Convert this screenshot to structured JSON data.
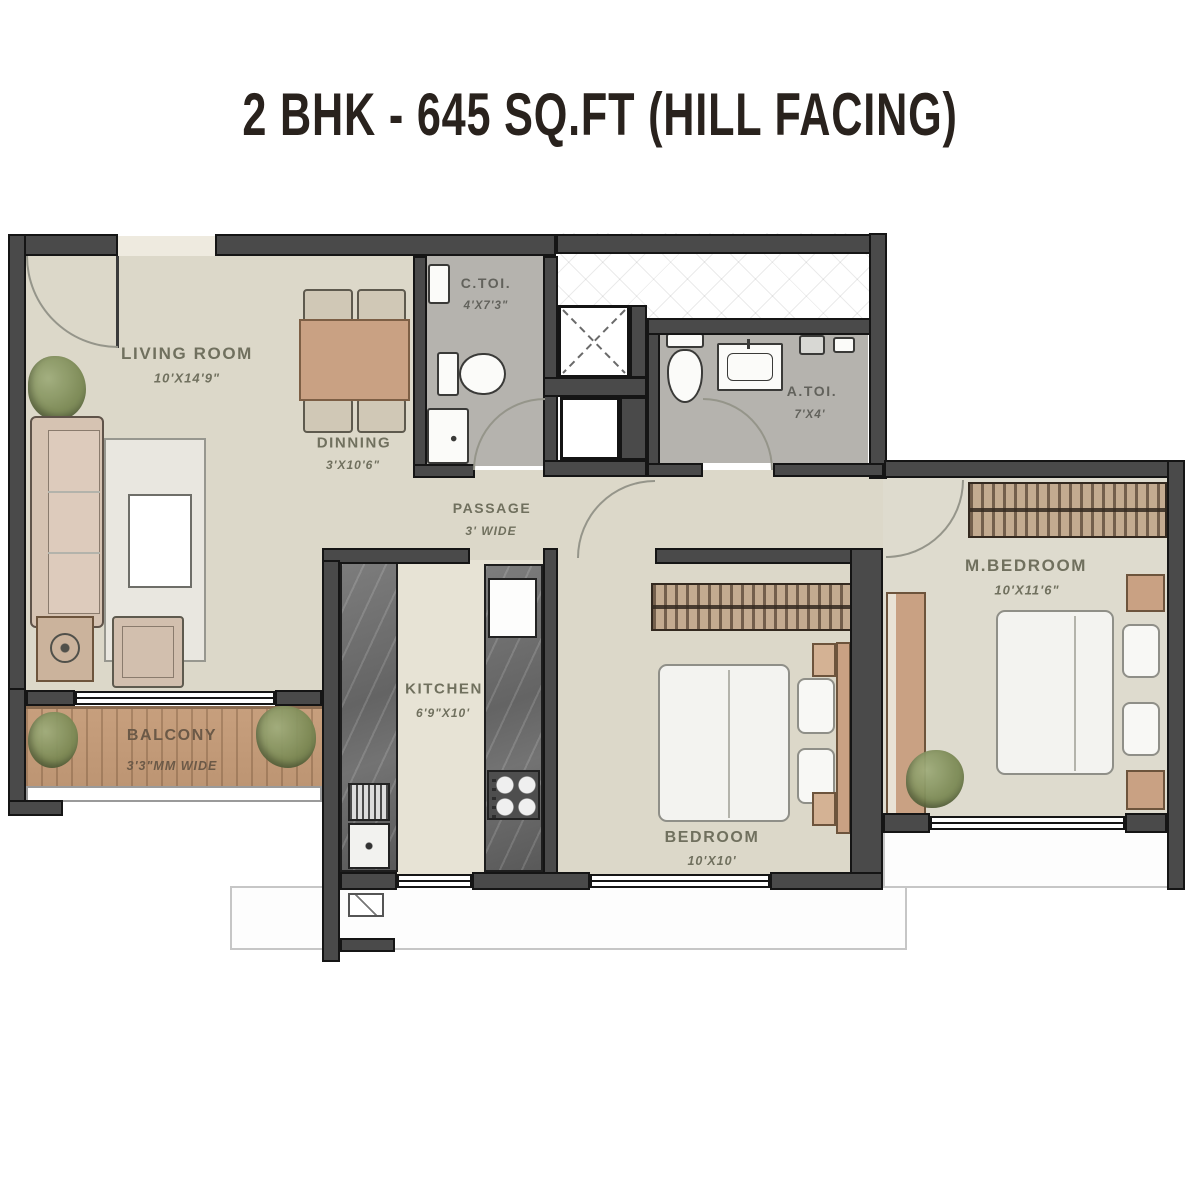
{
  "title": "2 BHK - 645 SQ.FT (HILL FACING)",
  "rooms": {
    "living": {
      "name": "LIVING ROOM",
      "dims": "10'X14'9\""
    },
    "dining": {
      "name": "DINNING",
      "dims": "3'X10'6\""
    },
    "ctoi": {
      "name": "C.TOI.",
      "dims": "4'X7'3\""
    },
    "atoi": {
      "name": "A.TOI.",
      "dims": "7'X4'"
    },
    "passage": {
      "name": "PASSAGE",
      "dims": "3' WIDE"
    },
    "kitchen": {
      "name": "KITCHEN",
      "dims": "6'9\"X10'"
    },
    "bedroom": {
      "name": "BEDROOM",
      "dims": "10'X10'"
    },
    "mbedroom": {
      "name": "M.BEDROOM",
      "dims": "10'X11'6\""
    },
    "balcony": {
      "name": "BALCONY",
      "dims": "3'3\"MM WIDE"
    }
  },
  "colors": {
    "wall": "#4a4a4a",
    "wallEdge": "#151515",
    "floor": "#dcd8c9",
    "kitchenFloor": "#e7e3d5",
    "toiletFloor": "#b5b3ae",
    "balconyWood": "#c79f7d",
    "tan": "#c9a183",
    "bedLinen": "#f3f3f0",
    "label": "#70705e",
    "balconyLabel": "#6b5947",
    "title": "#29221d",
    "arc": "#95958a",
    "plant": "#7c8a55"
  }
}
